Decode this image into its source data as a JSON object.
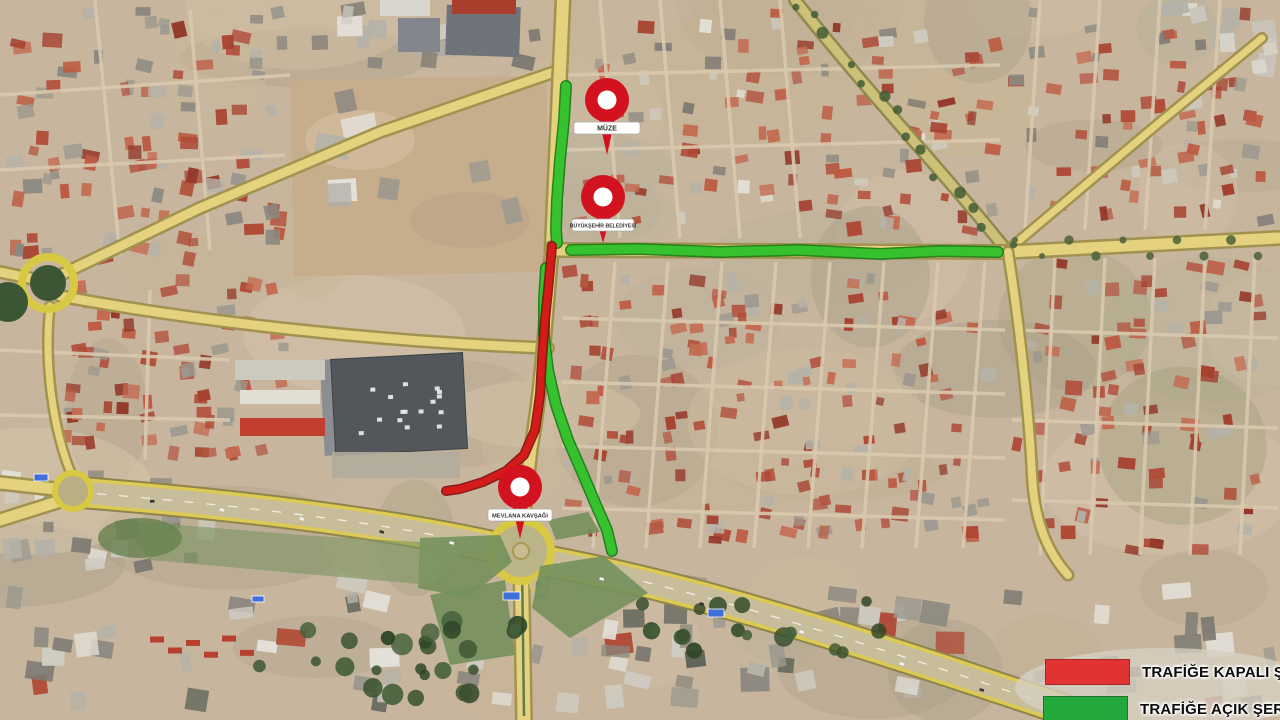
{
  "map": {
    "type": "satellite-traffic-plan",
    "pin_color": "#d31220",
    "pins": [
      {
        "id": "pin-muze",
        "label": "MÜZE",
        "x": 607,
        "y": 100,
        "pointer": 55,
        "label_w": 66,
        "font": 7
      },
      {
        "id": "pin-belediye",
        "label": "BÜYÜKŞEHİR BELEDİYESİ",
        "x": 603,
        "y": 197,
        "pointer": 46,
        "label_w": 62,
        "font": 5.2
      },
      {
        "id": "pin-kavsak",
        "label": "MEVLANA KAVŞAĞI",
        "x": 520,
        "y": 487,
        "pointer": 52,
        "label_w": 64,
        "font": 5.8
      }
    ],
    "routes": [
      {
        "id": "open-north",
        "status": "open",
        "color": "#35c22e",
        "edge_color": "#157a13",
        "width": 9,
        "points": [
          [
            566,
            86
          ],
          [
            564,
            120
          ],
          [
            560,
            160
          ],
          [
            557,
            200
          ],
          [
            556,
            230
          ],
          [
            557,
            243
          ]
        ]
      },
      {
        "id": "open-east",
        "status": "open",
        "color": "#35c22e",
        "edge_color": "#157a13",
        "width": 9,
        "points": [
          [
            571,
            250
          ],
          [
            640,
            249
          ],
          [
            720,
            252
          ],
          [
            800,
            250
          ],
          [
            880,
            254
          ],
          [
            940,
            251
          ],
          [
            998,
            252
          ]
        ]
      },
      {
        "id": "open-south",
        "status": "open",
        "color": "#35c22e",
        "edge_color": "#157a13",
        "width": 9,
        "points": [
          [
            546,
            268
          ],
          [
            544,
            300
          ],
          [
            544,
            335
          ],
          [
            548,
            370
          ],
          [
            556,
            405
          ],
          [
            568,
            440
          ],
          [
            582,
            472
          ],
          [
            596,
            505
          ],
          [
            607,
            530
          ],
          [
            612,
            551
          ]
        ]
      },
      {
        "id": "closed-center",
        "status": "closed",
        "color": "#d51a1a",
        "edge_color": "#7e0d0d",
        "width": 7,
        "points": [
          [
            552,
            246
          ],
          [
            549,
            280
          ],
          [
            545,
            320
          ],
          [
            542,
            360
          ],
          [
            540,
            395
          ],
          [
            535,
            430
          ],
          [
            524,
            455
          ],
          [
            506,
            471
          ],
          [
            483,
            482
          ],
          [
            460,
            489
          ],
          [
            446,
            491
          ]
        ]
      }
    ],
    "legend": {
      "items": [
        {
          "id": "closed",
          "label": "TRAFİĞE KAPALI ŞERİT",
          "color": "#e23333"
        },
        {
          "id": "open",
          "label": "TRAFİĞE AÇIK ŞERİT",
          "color": "#23a83c"
        }
      ]
    }
  }
}
